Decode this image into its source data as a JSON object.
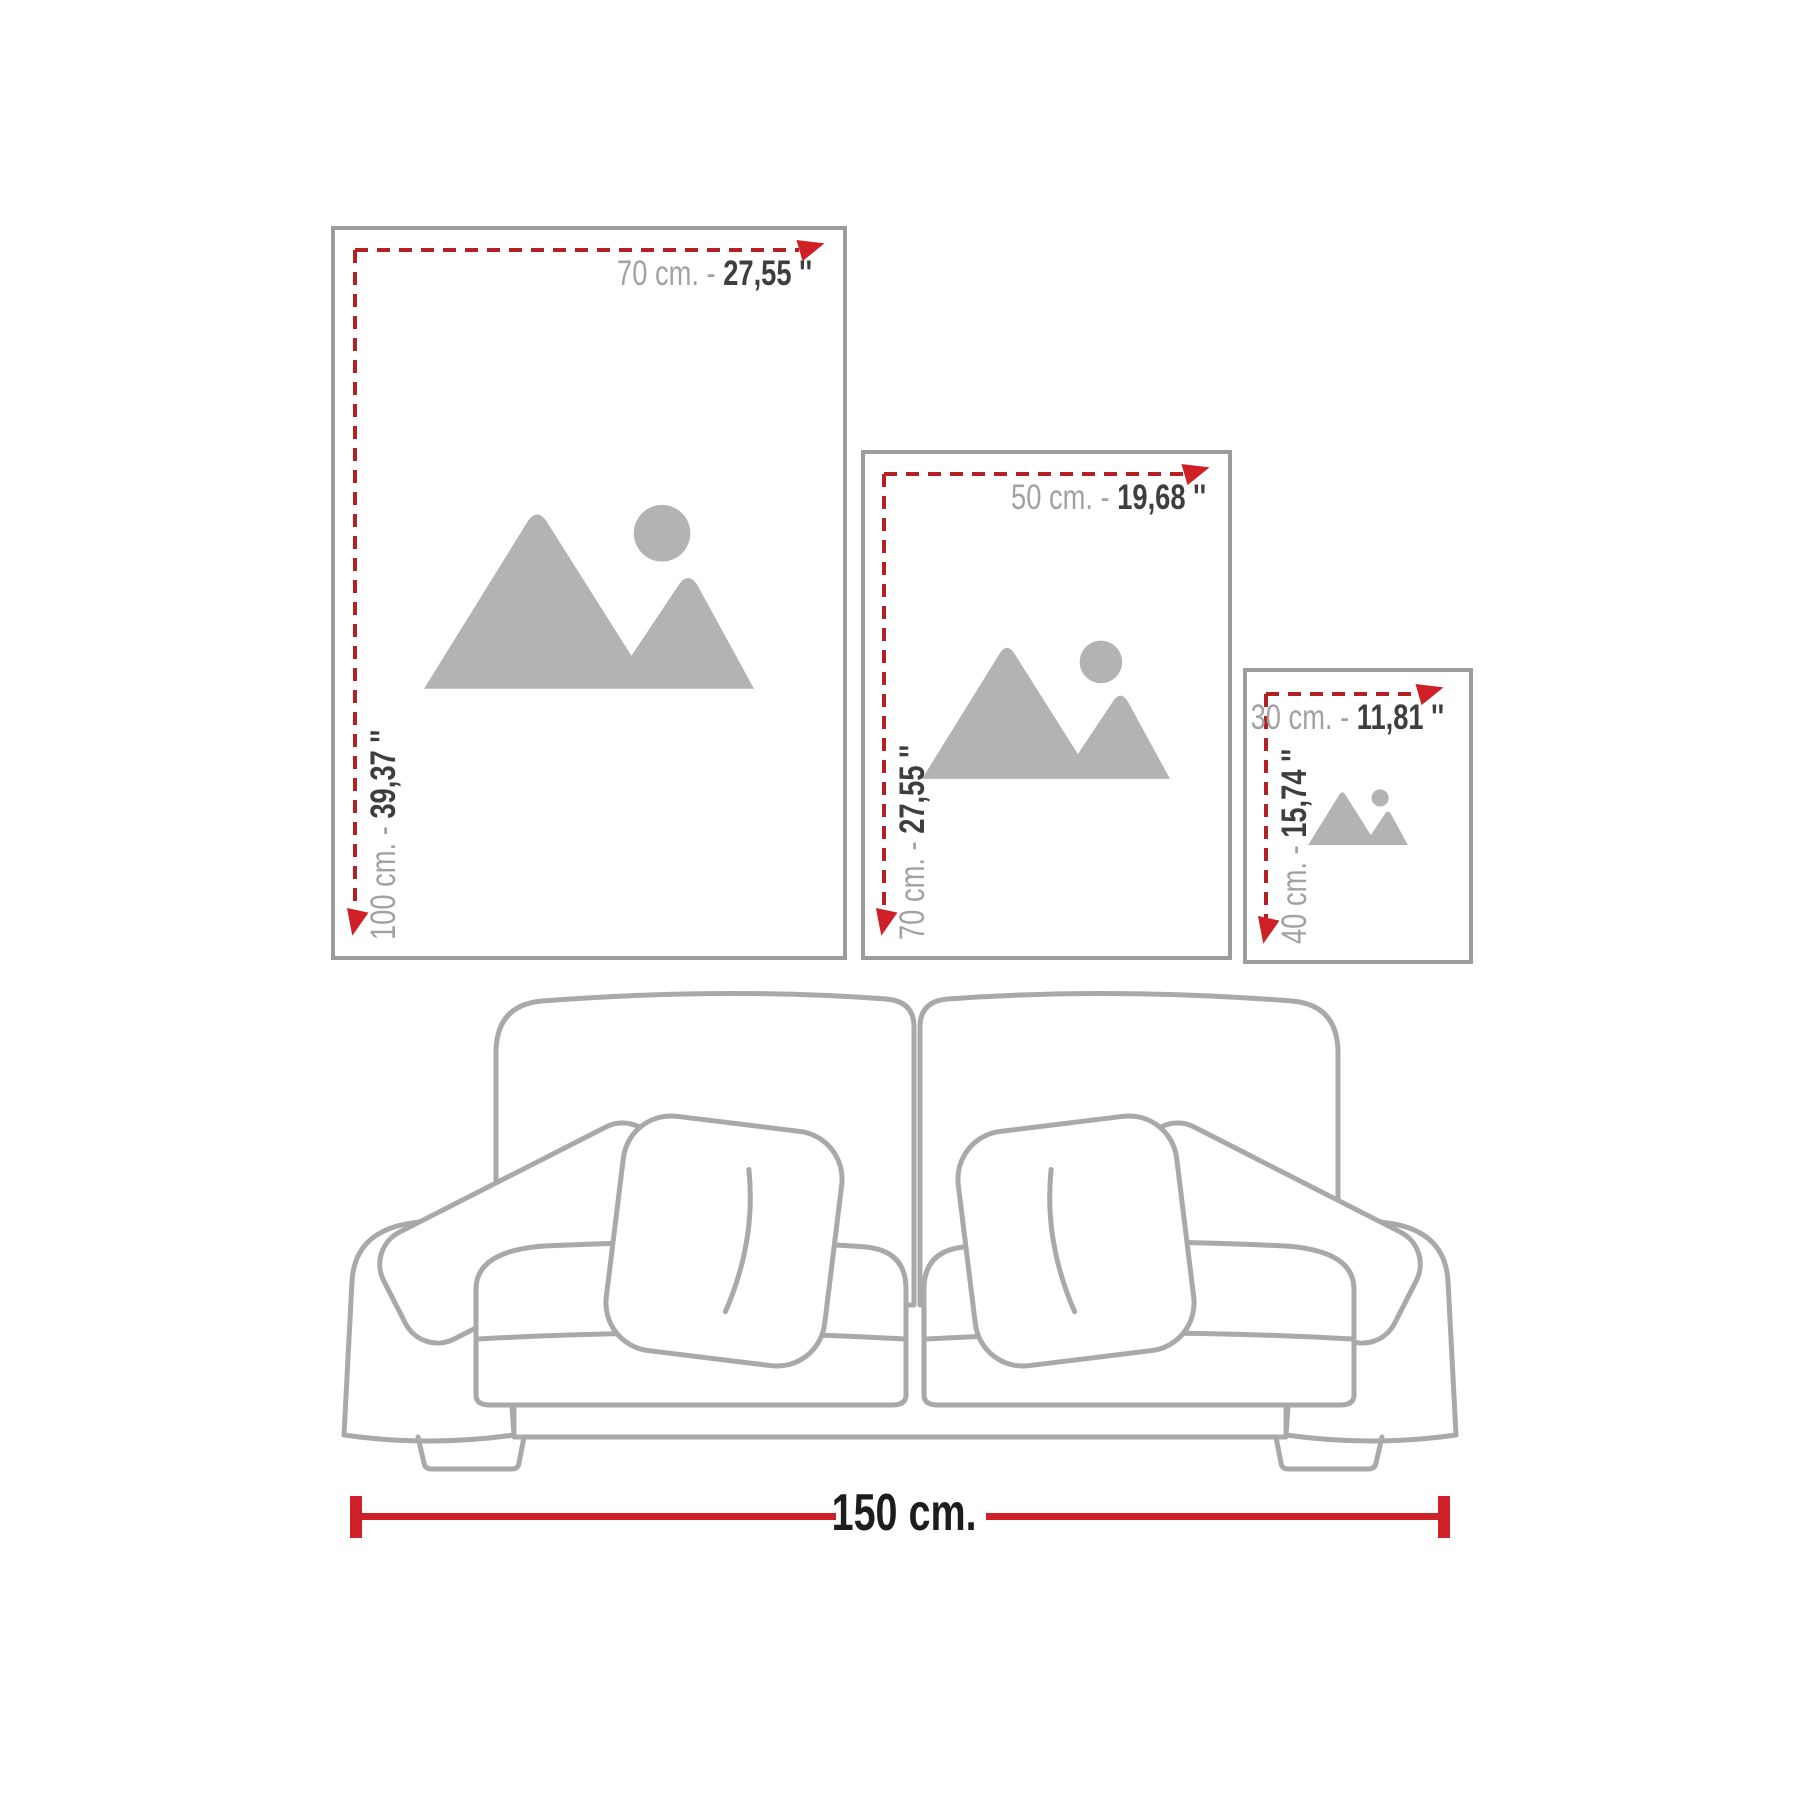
{
  "diagram": {
    "frames": [
      {
        "name": "large",
        "width_cm": "70 cm. - ",
        "width_in": "27,55 ''",
        "height_cm": "100 cm. - ",
        "height_in": "39,37 ''"
      },
      {
        "name": "medium",
        "width_cm": "50 cm. - ",
        "width_in": "19,68 ''",
        "height_cm": "70 cm. - ",
        "height_in": "27,55 ''"
      },
      {
        "name": "small",
        "width_cm": "30 cm. - ",
        "width_in": "11,81 ''",
        "height_cm": "40 cm. - ",
        "height_in": "15,74 ''"
      }
    ],
    "sofa_width_label": "150 cm.",
    "icons": {
      "placeholder": "image-placeholder-icon",
      "arrow_right": "arrow-right-icon",
      "arrow_down": "arrow-down-icon"
    },
    "colors": {
      "accent_red": "#cf2027",
      "dash_red": "#b52025",
      "frame_border": "#9c9c9c",
      "placeholder_gray": "#b3b3b3",
      "sofa_line_gray": "#a9a9a9",
      "label_gray": "#a2a2a2",
      "label_dark": "#3e3e3e",
      "sofa_label_dark": "#1d1d1d"
    }
  }
}
